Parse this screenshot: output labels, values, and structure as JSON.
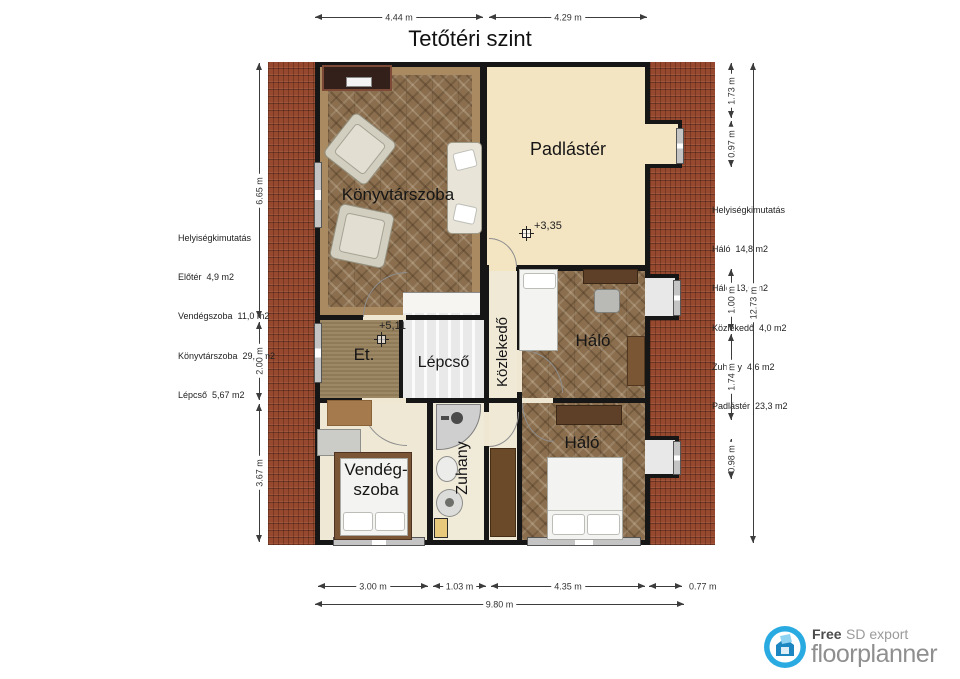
{
  "title": "Tetőtéri szint",
  "rooms": {
    "library": {
      "label": "Könyvtárszoba"
    },
    "attic": {
      "label": "Padlástér",
      "level": "+3,35"
    },
    "entry": {
      "label": "Et.",
      "level": "+5,11"
    },
    "stairs": {
      "label": "Lépcső"
    },
    "hallway": {
      "label": "Közlekedő"
    },
    "bedroom_upper": {
      "label": "Háló"
    },
    "bedroom_lower": {
      "label": "Háló"
    },
    "guest": {
      "label_line1": "Vendég-",
      "label_line2": "szoba"
    },
    "shower": {
      "label": "Zuhany"
    }
  },
  "dimensions": {
    "top": [
      "4.44 m",
      "4.29 m"
    ],
    "bottom_segments": [
      "3.00 m",
      "1.03 m",
      "4.35 m",
      "0.77 m"
    ],
    "bottom_total": "9.80 m",
    "left": [
      "6.65 m",
      "2.00 m",
      "3.67 m"
    ],
    "right_segments": [
      "1.73 m",
      "0.97 m",
      "1.00 m",
      "1.74 m",
      "0.98 m"
    ],
    "right_total": "12.73 m"
  },
  "legend_left": {
    "title": "Helyiségkimutatás",
    "rows": [
      "Előtér  4,9 m2",
      "Vendégszoba  11,0 m2",
      "Könyvtárszoba  29,5 m2",
      "Lépcső  5,67 m2"
    ]
  },
  "legend_right": {
    "title": "Helyiségkimutatás",
    "rows": [
      "Háló  14,8 m2",
      "Háló  13,0 m2",
      "Közlekedő  4,0 m2",
      "Zuhany  4,6 m2",
      "Padlástér  23,3 m2"
    ]
  },
  "logo": {
    "free": "Free",
    "export": "SD export",
    "brand": "floorplanner"
  },
  "colors": {
    "roof_tile": "#96492f",
    "wood_floor": "#8a6e4e",
    "attic_floor": "#f3e4c2",
    "wall": "#161616",
    "logo_accent": "#29abe2"
  }
}
